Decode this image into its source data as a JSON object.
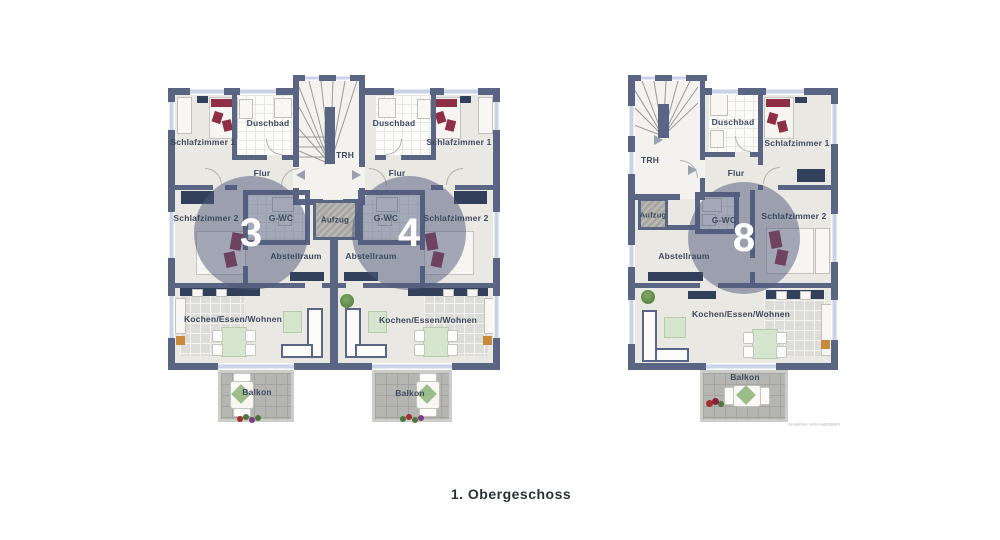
{
  "caption": "1. Obergeschoss",
  "disclaimer": "Grundrisse nicht maßstäblich",
  "colors": {
    "wall": "#5a6583",
    "floor": "#eae8e2",
    "stair_floor": "#f3f2ee",
    "bath_tile": "#fbfbf9",
    "kitchen_tile": "#dcdcd8",
    "balcony": "#b5b5b2",
    "unit_circle": "#4d587a",
    "unit_number_text": "#ffffff",
    "label_text": "#3d4a60",
    "bed_accent": "#8e2f45",
    "furniture_navy": "#33405c",
    "table_green": "#d6e5cd",
    "elevator_gray": "#a7a6a2",
    "window_glass": "#c9d2e6"
  },
  "shared": {
    "left_trh": "TRH",
    "left_aufzug": "Aufzug",
    "right_trh": "TRH",
    "right_aufzug": "Aufzug"
  },
  "units": {
    "u3": {
      "number": "3",
      "sz1": "Schlafzimmer 1",
      "duschbad": "Duschbad",
      "flur": "Flur",
      "sz2": "Schlafzimmer 2",
      "gwc": "G-WC",
      "abstell": "Abstellraum",
      "kew": "Kochen/Essen/Wohnen",
      "balkon": "Balkon"
    },
    "u4": {
      "number": "4",
      "sz1": "Schlafzimmer 1",
      "duschbad": "Duschbad",
      "flur": "Flur",
      "sz2": "Schlafzimmer 2",
      "gwc": "G-WC",
      "abstell": "Abstellraum",
      "kew": "Kochen/Essen/Wohnen",
      "balkon": "Balkon"
    },
    "u8": {
      "number": "8",
      "sz1": "Schlafzimmer 1",
      "duschbad": "Duschbad",
      "flur": "Flur",
      "sz2": "Schlafzimmer 2",
      "gwc": "G-WC",
      "abstell": "Abstellraum",
      "kew": "Kochen/Essen/Wohnen",
      "balkon": "Balkon"
    }
  }
}
